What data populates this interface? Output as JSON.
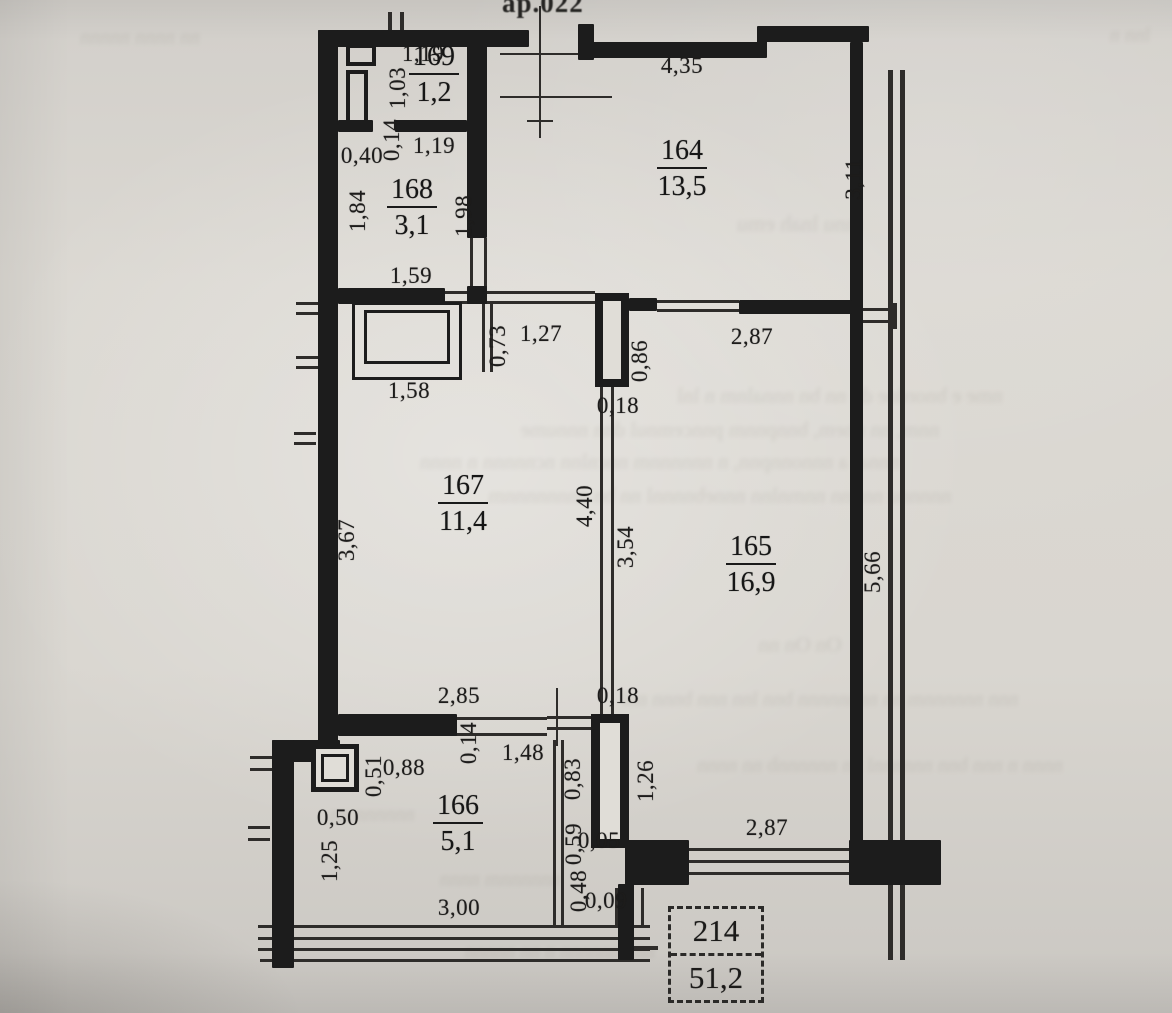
{
  "document": {
    "kind": "Scanned apartment floor plan",
    "top_edge_label": "ар.022",
    "summary_box": {
      "apartment_number": "214",
      "total_area": "51,2"
    }
  },
  "rooms": [
    {
      "id": "169",
      "area": "1,2",
      "x": 434,
      "y": 75
    },
    {
      "id": "168",
      "area": "3,1",
      "x": 412,
      "y": 208
    },
    {
      "id": "164",
      "area": "13,5",
      "x": 682,
      "y": 169
    },
    {
      "id": "167",
      "area": "11,4",
      "x": 463,
      "y": 504
    },
    {
      "id": "165",
      "area": "16,9",
      "x": 751,
      "y": 565
    },
    {
      "id": "166",
      "area": "5,1",
      "x": 458,
      "y": 824
    }
  ],
  "dimensions": [
    {
      "v": "1,19",
      "x": 423,
      "y": 54,
      "o": "h"
    },
    {
      "v": "1,03",
      "x": 398,
      "y": 88,
      "o": "v"
    },
    {
      "v": "0,14",
      "x": 392,
      "y": 140,
      "o": "v"
    },
    {
      "v": "1,19",
      "x": 434,
      "y": 146,
      "o": "h"
    },
    {
      "v": "0,40",
      "x": 362,
      "y": 156,
      "o": "h"
    },
    {
      "v": "1,84",
      "x": 358,
      "y": 211,
      "o": "v"
    },
    {
      "v": "1,98",
      "x": 464,
      "y": 216,
      "o": "v"
    },
    {
      "v": "1,59",
      "x": 411,
      "y": 276,
      "o": "h"
    },
    {
      "v": "4,35",
      "x": 682,
      "y": 66,
      "o": "h"
    },
    {
      "v": "3,11",
      "x": 854,
      "y": 179,
      "o": "v"
    },
    {
      "v": "1,58",
      "x": 409,
      "y": 391,
      "o": "h"
    },
    {
      "v": "0,73",
      "x": 498,
      "y": 346,
      "o": "v"
    },
    {
      "v": "1,27",
      "x": 541,
      "y": 334,
      "o": "h"
    },
    {
      "v": "0,86",
      "x": 640,
      "y": 361,
      "o": "v"
    },
    {
      "v": "2,87",
      "x": 752,
      "y": 337,
      "o": "h"
    },
    {
      "v": "0,18",
      "x": 618,
      "y": 406,
      "o": "h"
    },
    {
      "v": "3,67",
      "x": 347,
      "y": 540,
      "o": "v"
    },
    {
      "v": "4,40",
      "x": 585,
      "y": 506,
      "o": "v"
    },
    {
      "v": "3,54",
      "x": 626,
      "y": 547,
      "o": "v"
    },
    {
      "v": "5,66",
      "x": 873,
      "y": 572,
      "o": "v"
    },
    {
      "v": "2,85",
      "x": 459,
      "y": 696,
      "o": "h"
    },
    {
      "v": "0,18",
      "x": 618,
      "y": 696,
      "o": "h"
    },
    {
      "v": "0,14",
      "x": 469,
      "y": 743,
      "o": "v"
    },
    {
      "v": "1,48",
      "x": 523,
      "y": 753,
      "o": "h"
    },
    {
      "v": "0,83",
      "x": 573,
      "y": 779,
      "o": "v"
    },
    {
      "v": "1,26",
      "x": 646,
      "y": 781,
      "o": "v"
    },
    {
      "v": "0,88",
      "x": 404,
      "y": 768,
      "o": "h"
    },
    {
      "v": "0,51",
      "x": 374,
      "y": 776,
      "o": "v"
    },
    {
      "v": "0,50",
      "x": 338,
      "y": 818,
      "o": "h"
    },
    {
      "v": "1,25",
      "x": 330,
      "y": 861,
      "o": "v"
    },
    {
      "v": "3,00",
      "x": 459,
      "y": 908,
      "o": "h"
    },
    {
      "v": "0,59",
      "x": 574,
      "y": 844,
      "o": "v"
    },
    {
      "v": "0,05",
      "x": 599,
      "y": 841,
      "o": "h"
    },
    {
      "v": "0,48",
      "x": 579,
      "y": 891,
      "o": "v"
    },
    {
      "v": "0,09",
      "x": 606,
      "y": 901,
      "o": "h"
    },
    {
      "v": "2,87",
      "x": 767,
      "y": 828,
      "o": "h"
    }
  ],
  "artifacts": {
    "ghost_lines": [
      {
        "t": "mnu lnah emu",
        "x": 800,
        "y": 224,
        "s": 22
      },
      {
        "t": "nme e bnordne dn nn  bn nnnalnm n  lnl",
        "x": 840,
        "y": 396,
        "s": 21
      },
      {
        "t": "nnm, nn nnem, bnnpnnm pnncemnul dnn nnnume",
        "x": 730,
        "y": 430,
        "s": 21
      },
      {
        "t": "nnnal  a nnnonnpnn, n nnnnnnm nncnlnn  ncnnnnn  n nnnn",
        "x": 660,
        "y": 462,
        "s": 21
      },
      {
        "t": "nnnnnu nnnnn nnmnlnn nnnebnnnnl nn bn nnnnnnnnm",
        "x": 720,
        "y": 496,
        "s": 21
      },
      {
        "t": "On On nn",
        "x": 800,
        "y": 645,
        "s": 21
      },
      {
        "t": "nnn nnnnnnm  nn nnnnnnnn bnn  lnn nnn bnnn nnl",
        "x": 820,
        "y": 700,
        "s": 20
      },
      {
        "t": "nnnn n nnn  bnn nnnnnnl nn  nnnnnnb nn nnnn",
        "x": 880,
        "y": 766,
        "s": 20
      },
      {
        "t": "nnnnnn nn",
        "x": 372,
        "y": 815,
        "s": 20
      },
      {
        "t": "nnnnnnm nnnn",
        "x": 500,
        "y": 880,
        "s": 20
      },
      {
        "t": "nnn nnnnnn n nn nnnnn",
        "x": 560,
        "y": 952,
        "s": 20
      },
      {
        "t": "nn nnnn nnnnn",
        "x": 140,
        "y": 38,
        "s": 20
      },
      {
        "t": "lnn n",
        "x": 1130,
        "y": 36,
        "s": 20
      }
    ]
  }
}
